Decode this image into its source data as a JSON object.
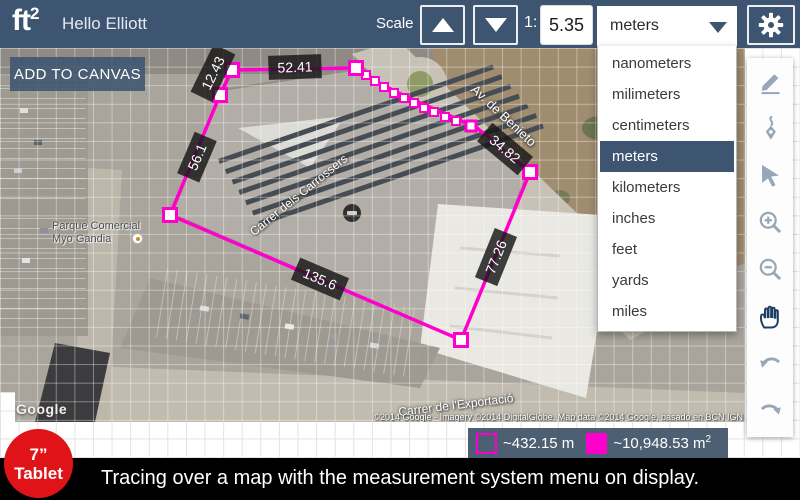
{
  "topbar": {
    "logo_text": "ft",
    "logo_sup": "2",
    "greeting": "Hello Elliott",
    "scale_label": "Scale",
    "ratio_prefix": "1:",
    "scale_value": "5.35",
    "unit_selected": "meters"
  },
  "add_to_canvas": "ADD TO CANVAS",
  "unit_menu": {
    "items": [
      "nanometers",
      "milimeters",
      "centimeters",
      "meters",
      "kilometers",
      "inches",
      "feet",
      "yards",
      "miles"
    ],
    "selected": "meters"
  },
  "tracing": {
    "segment_labels": [
      {
        "value": "12.43"
      },
      {
        "value": "52.41"
      },
      {
        "value": "34.82"
      },
      {
        "value": "77.26"
      },
      {
        "value": "135.6"
      },
      {
        "value": "56.1"
      }
    ]
  },
  "toolbar_tools": [
    "pencil",
    "pen",
    "select-arrow",
    "zoom-in",
    "zoom-out",
    "pan-hand",
    "undo",
    "redo"
  ],
  "legend": {
    "perimeter_value": "~432.15 m",
    "area_value": "~10,948.53 m",
    "area_sup": "2"
  },
  "map_labels": {
    "street1": "Av. de Benieto",
    "street2": "Carrer dels Carrossers",
    "street3": "Carrer de l'Exportació",
    "poi_line1": "Parque Comercial",
    "poi_line2": "Myo Gandia",
    "watermark": "Google",
    "attribution": "©2014 Google - Imagery ©2014 DigitalGlobe, Map data ©2014 Google, basado en BCN IGN"
  },
  "badge": {
    "line1": "7”",
    "line2": "Tablet"
  },
  "caption": "Tracing over a map with the measurement system menu on display.",
  "colors": {
    "accent_magenta": "#ff00cc",
    "topbar_blue": "#3e5571",
    "badge_red": "#e01319",
    "legend_bg": "#405468"
  }
}
